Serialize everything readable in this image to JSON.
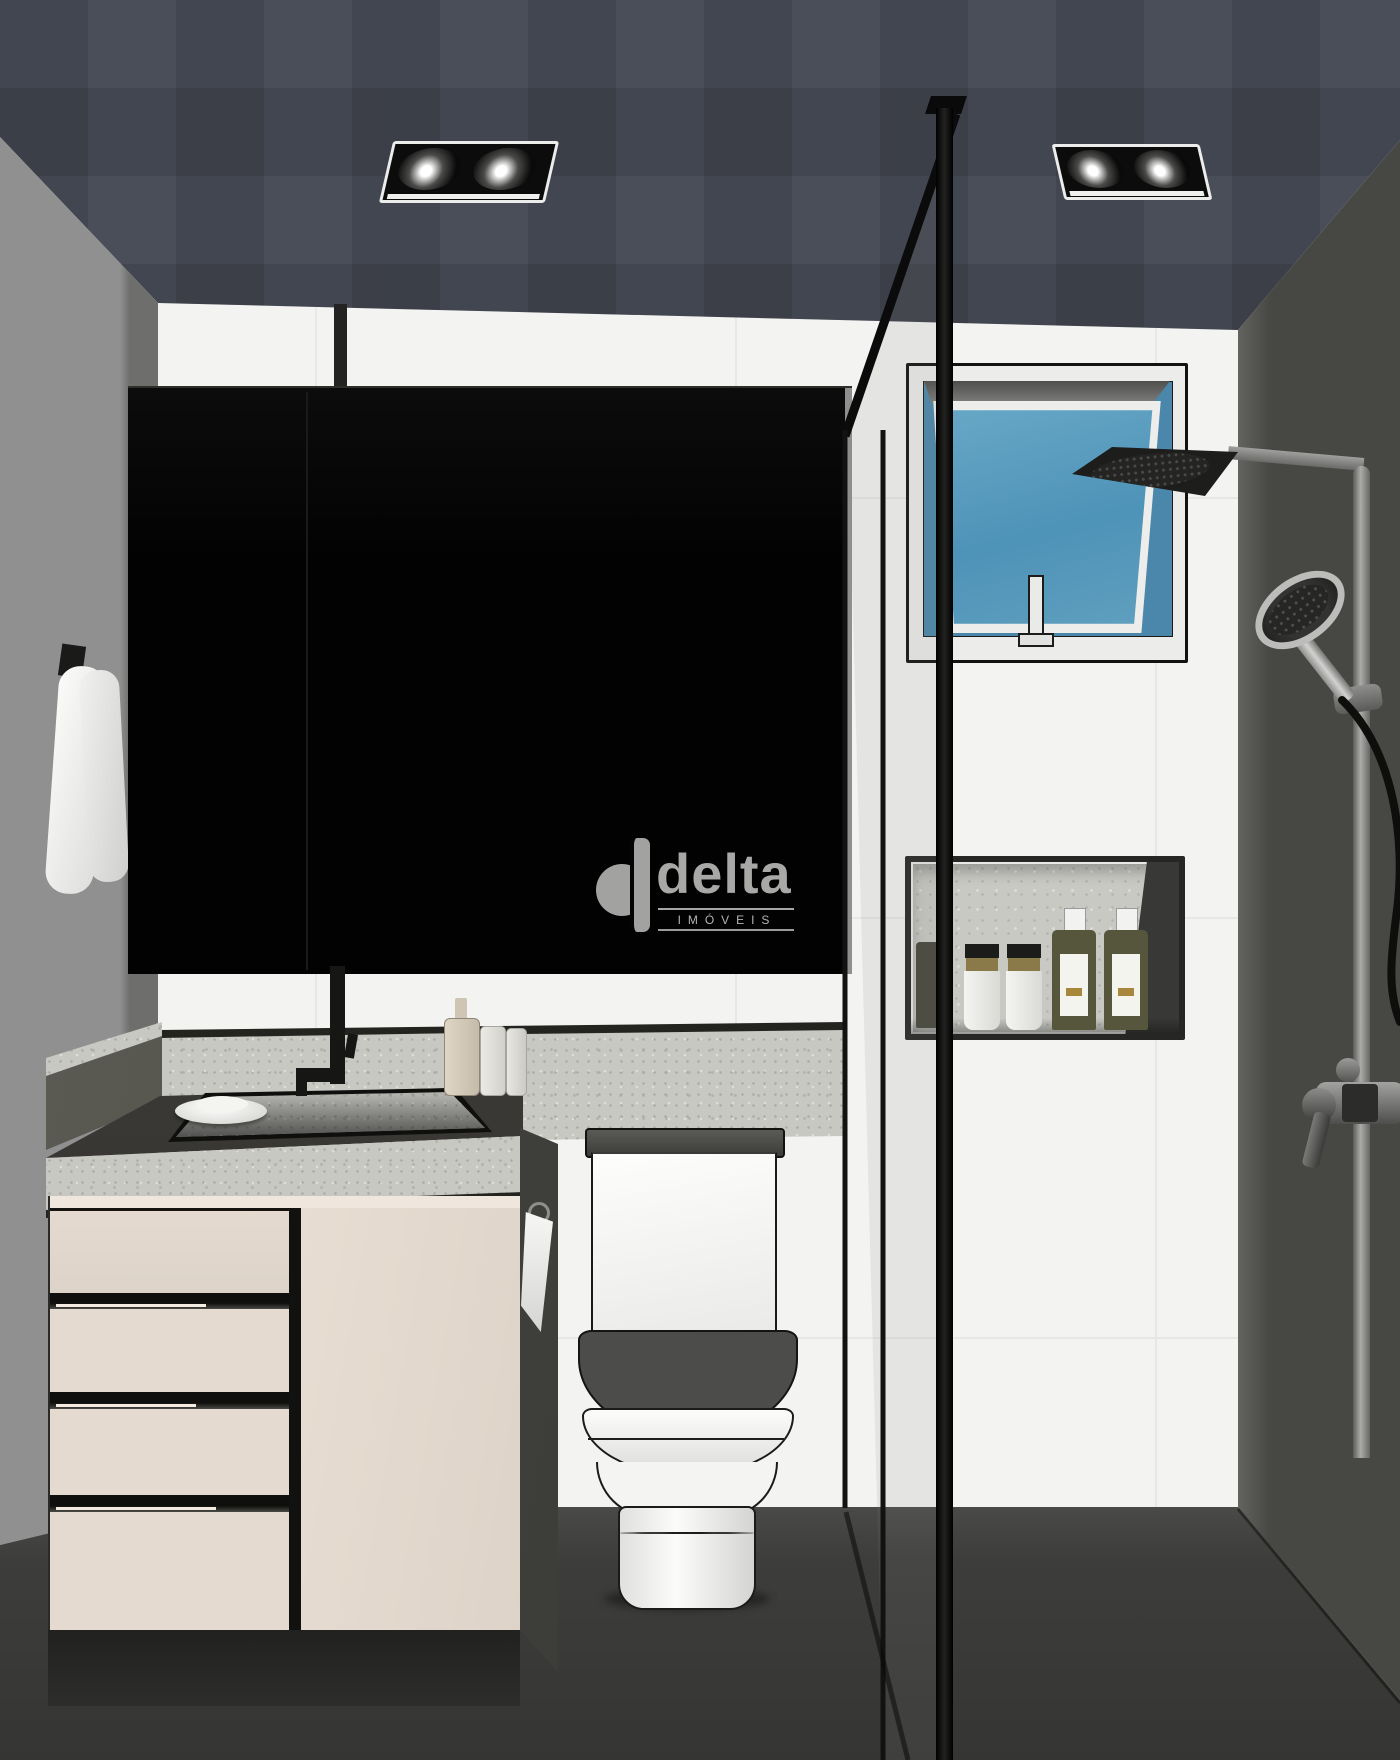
{
  "scene": {
    "type": "3D architectural interior rendering",
    "room": "bathroom",
    "objects": [
      "checkered dark ceiling with two recessed twin spotlights",
      "grey left wall with towel hook and white towel",
      "white tiled back wall",
      "large black framed mirror above vanity",
      "awning window with blue sky and white frame",
      "black square rain shower head on wall arm",
      "chrome hand shower with hose, slide bar and mixer valve",
      "recessed wall niche with toiletry bottles and tubes",
      "granite vanity counter with recessed dark basin",
      "tall black basin faucet with ceiling pipe",
      "soap dish and dispenser bottles on counter",
      "cream vanity cabinet with four drawers and one door",
      "dark cabinet side panel with hand towel ring",
      "close-coupled white toilet with grey lid and seat",
      "black framed glass shower screen",
      "dark grey shower-side wall and dark floor"
    ]
  },
  "watermark": {
    "brand": "delta",
    "subtitle": "IMÓVEIS"
  },
  "palette": {
    "ceiling": "#4a4e59",
    "left_wall": "#8d8d8b",
    "back_wall": "#f3f3f1",
    "right_wall": "#474743",
    "floor": "#3a3a38",
    "mirror_black": "#060606",
    "cabinet_cream": "#e4dacf",
    "granite": "#c8c8c3",
    "counter_deck": "#3f3d39",
    "window_sky_blue": "#5b9cbd",
    "fixture_black": "#141412",
    "toilet_white": "#f6f6f4",
    "seat_grey": "#4c4c4a",
    "bottle_olive": "#56563c",
    "towel_white": "#f2f2f0",
    "watermark_grey": "#a6a6a4"
  }
}
